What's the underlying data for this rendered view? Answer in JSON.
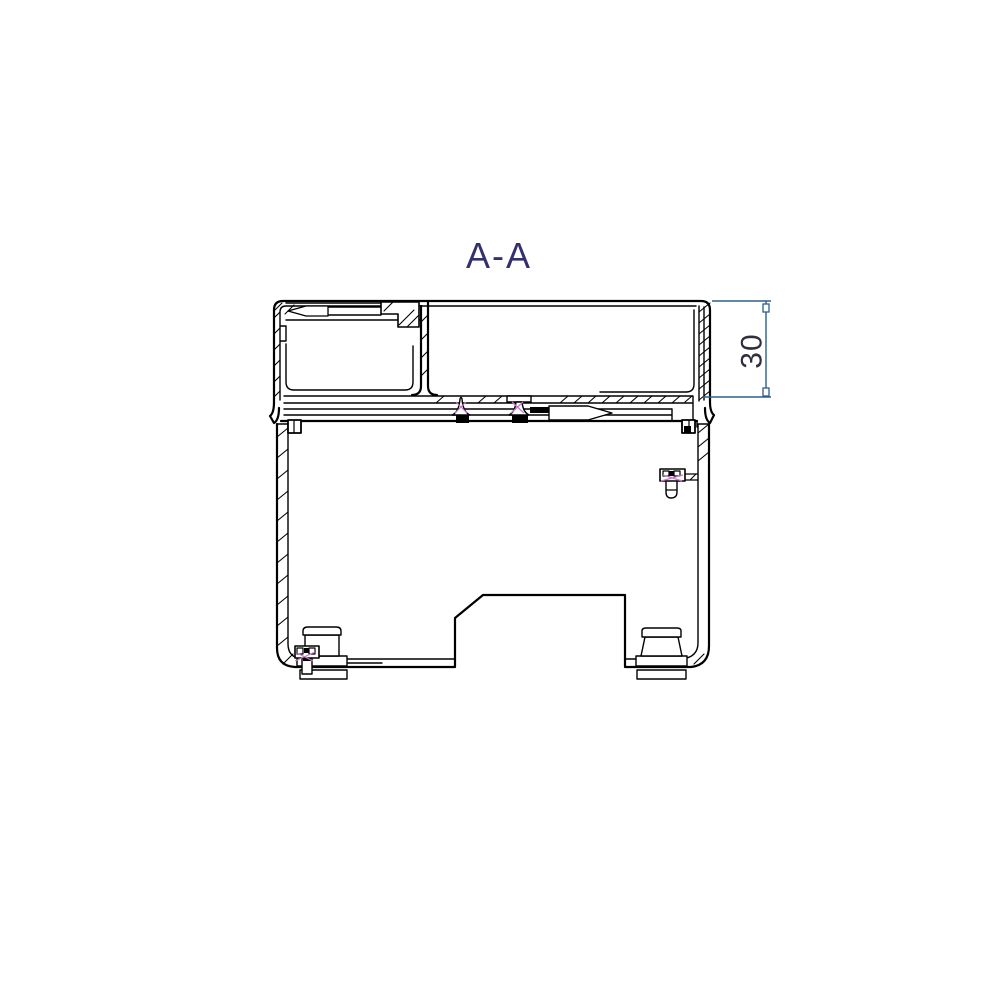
{
  "title": {
    "text": "A-A"
  },
  "dimension": {
    "label": "30"
  },
  "colors": {
    "background": "#ffffff",
    "outline": "#000000",
    "title": "#32316e",
    "dimension_line": "#2e5e8c",
    "dimension_text": "#2e2e3e",
    "thread": "#c678c6"
  }
}
